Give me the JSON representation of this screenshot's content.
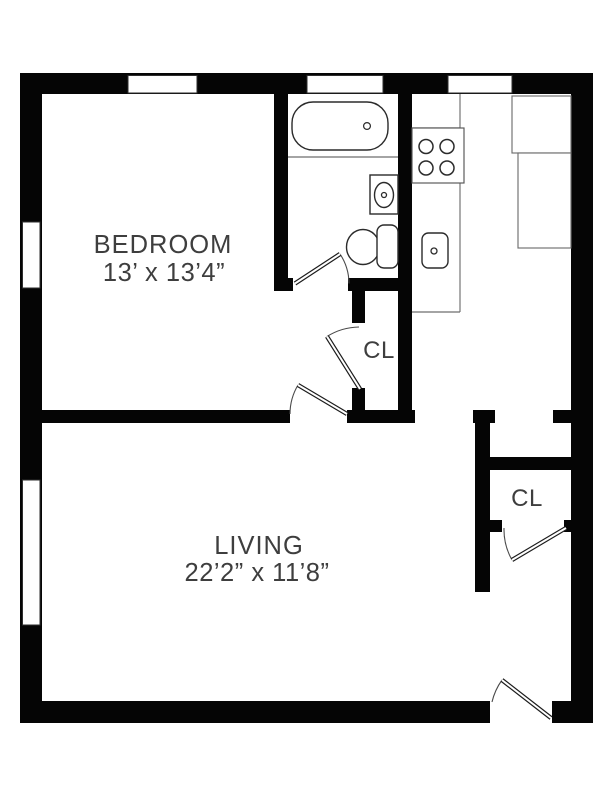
{
  "plan": {
    "type": "apartment-floor-plan",
    "colors": {
      "background": "#ffffff",
      "wall": "#050505",
      "fixture_line": "#2b2b2b",
      "counter_line": "#6e6e6e",
      "label_text": "#3e3e3e"
    },
    "rooms": {
      "bedroom": {
        "label": "BEDROOM",
        "dimensions": "13’ x 13’4”"
      },
      "living": {
        "label": "LIVING",
        "dimensions": "22’2” x 11’8”"
      },
      "hall_closet": {
        "label": "CL"
      },
      "entry_closet": {
        "label": "CL"
      }
    },
    "features": [
      "bathtub",
      "bathroom-sink",
      "toilet",
      "stove-four-burners",
      "kitchen-sink",
      "refrigerator",
      "kitchen-counters",
      "bathroom-door",
      "bedroom-door",
      "hall-closet-door",
      "entry-closet-door",
      "entry-door",
      "five-windows"
    ]
  }
}
